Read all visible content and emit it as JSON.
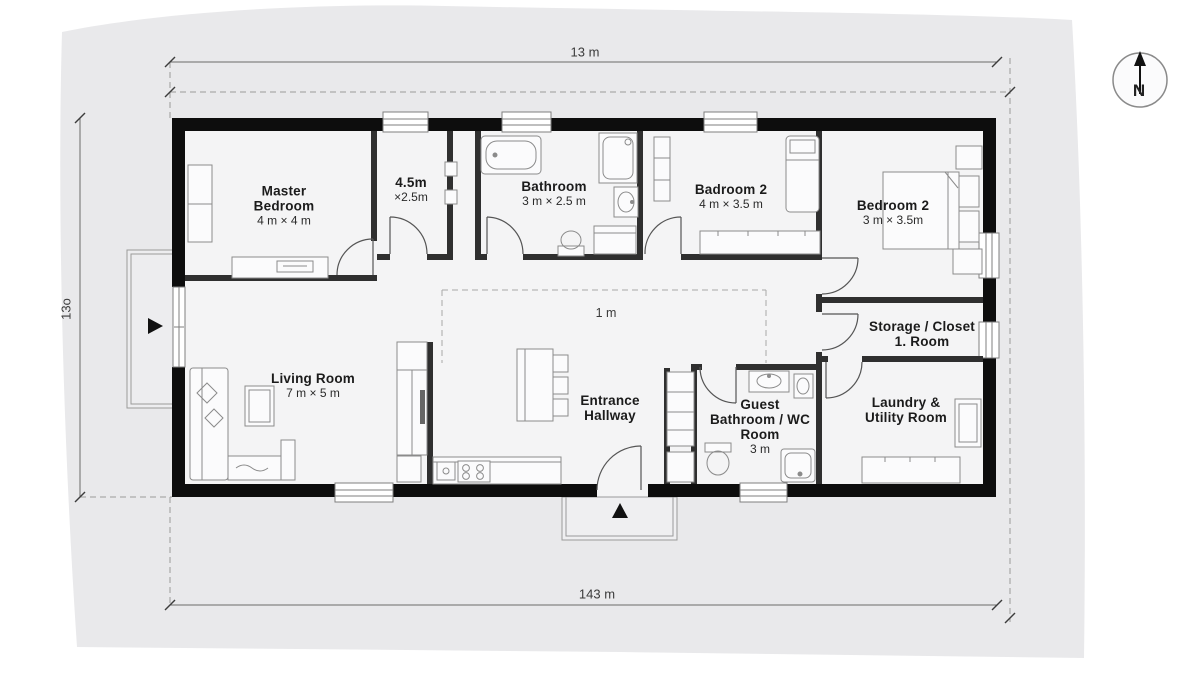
{
  "annotations": {
    "top_width": "13 m",
    "left_height": "13o",
    "bottom_width": "143 m",
    "hallway_width": "1 m",
    "compass_north": "N"
  },
  "colors": {
    "site_fill": "#e9e9eb",
    "floor_fill": "#f4f4f5",
    "exterior_wall": "#0d0d0d",
    "interior_wall": "#2f2f2f",
    "label_text": "#1b1b1b"
  },
  "rooms": {
    "master": {
      "lines": [
        "Master",
        "Bedroom"
      ],
      "dims": "4 m × 4 m"
    },
    "hall45": {
      "lines": [
        "4.5m"
      ],
      "dims": "×2.5m"
    },
    "bathroom": {
      "lines": [
        "Bathroom"
      ],
      "dims": "3 m × 2.5 m"
    },
    "badroom2": {
      "lines": [
        "Badroom 2"
      ],
      "dims": "4 m × 3.5 m"
    },
    "bedroom2": {
      "lines": [
        "Bedroom 2"
      ],
      "dims": "3 m × 3.5m"
    },
    "living": {
      "lines": [
        "Living Room"
      ],
      "dims": "7 m × 5 m"
    },
    "entrance": {
      "lines": [
        "Entrance",
        "Hallway"
      ],
      "dims": ""
    },
    "guest": {
      "lines": [
        "Guest",
        "Bathroom / WC",
        "Room"
      ],
      "dims": "3 m"
    },
    "storage": {
      "lines": [
        "Storage / Closet",
        "1. Room"
      ],
      "dims": ""
    },
    "laundry": {
      "lines": [
        "Laundry &",
        "Utility Room"
      ],
      "dims": ""
    }
  }
}
